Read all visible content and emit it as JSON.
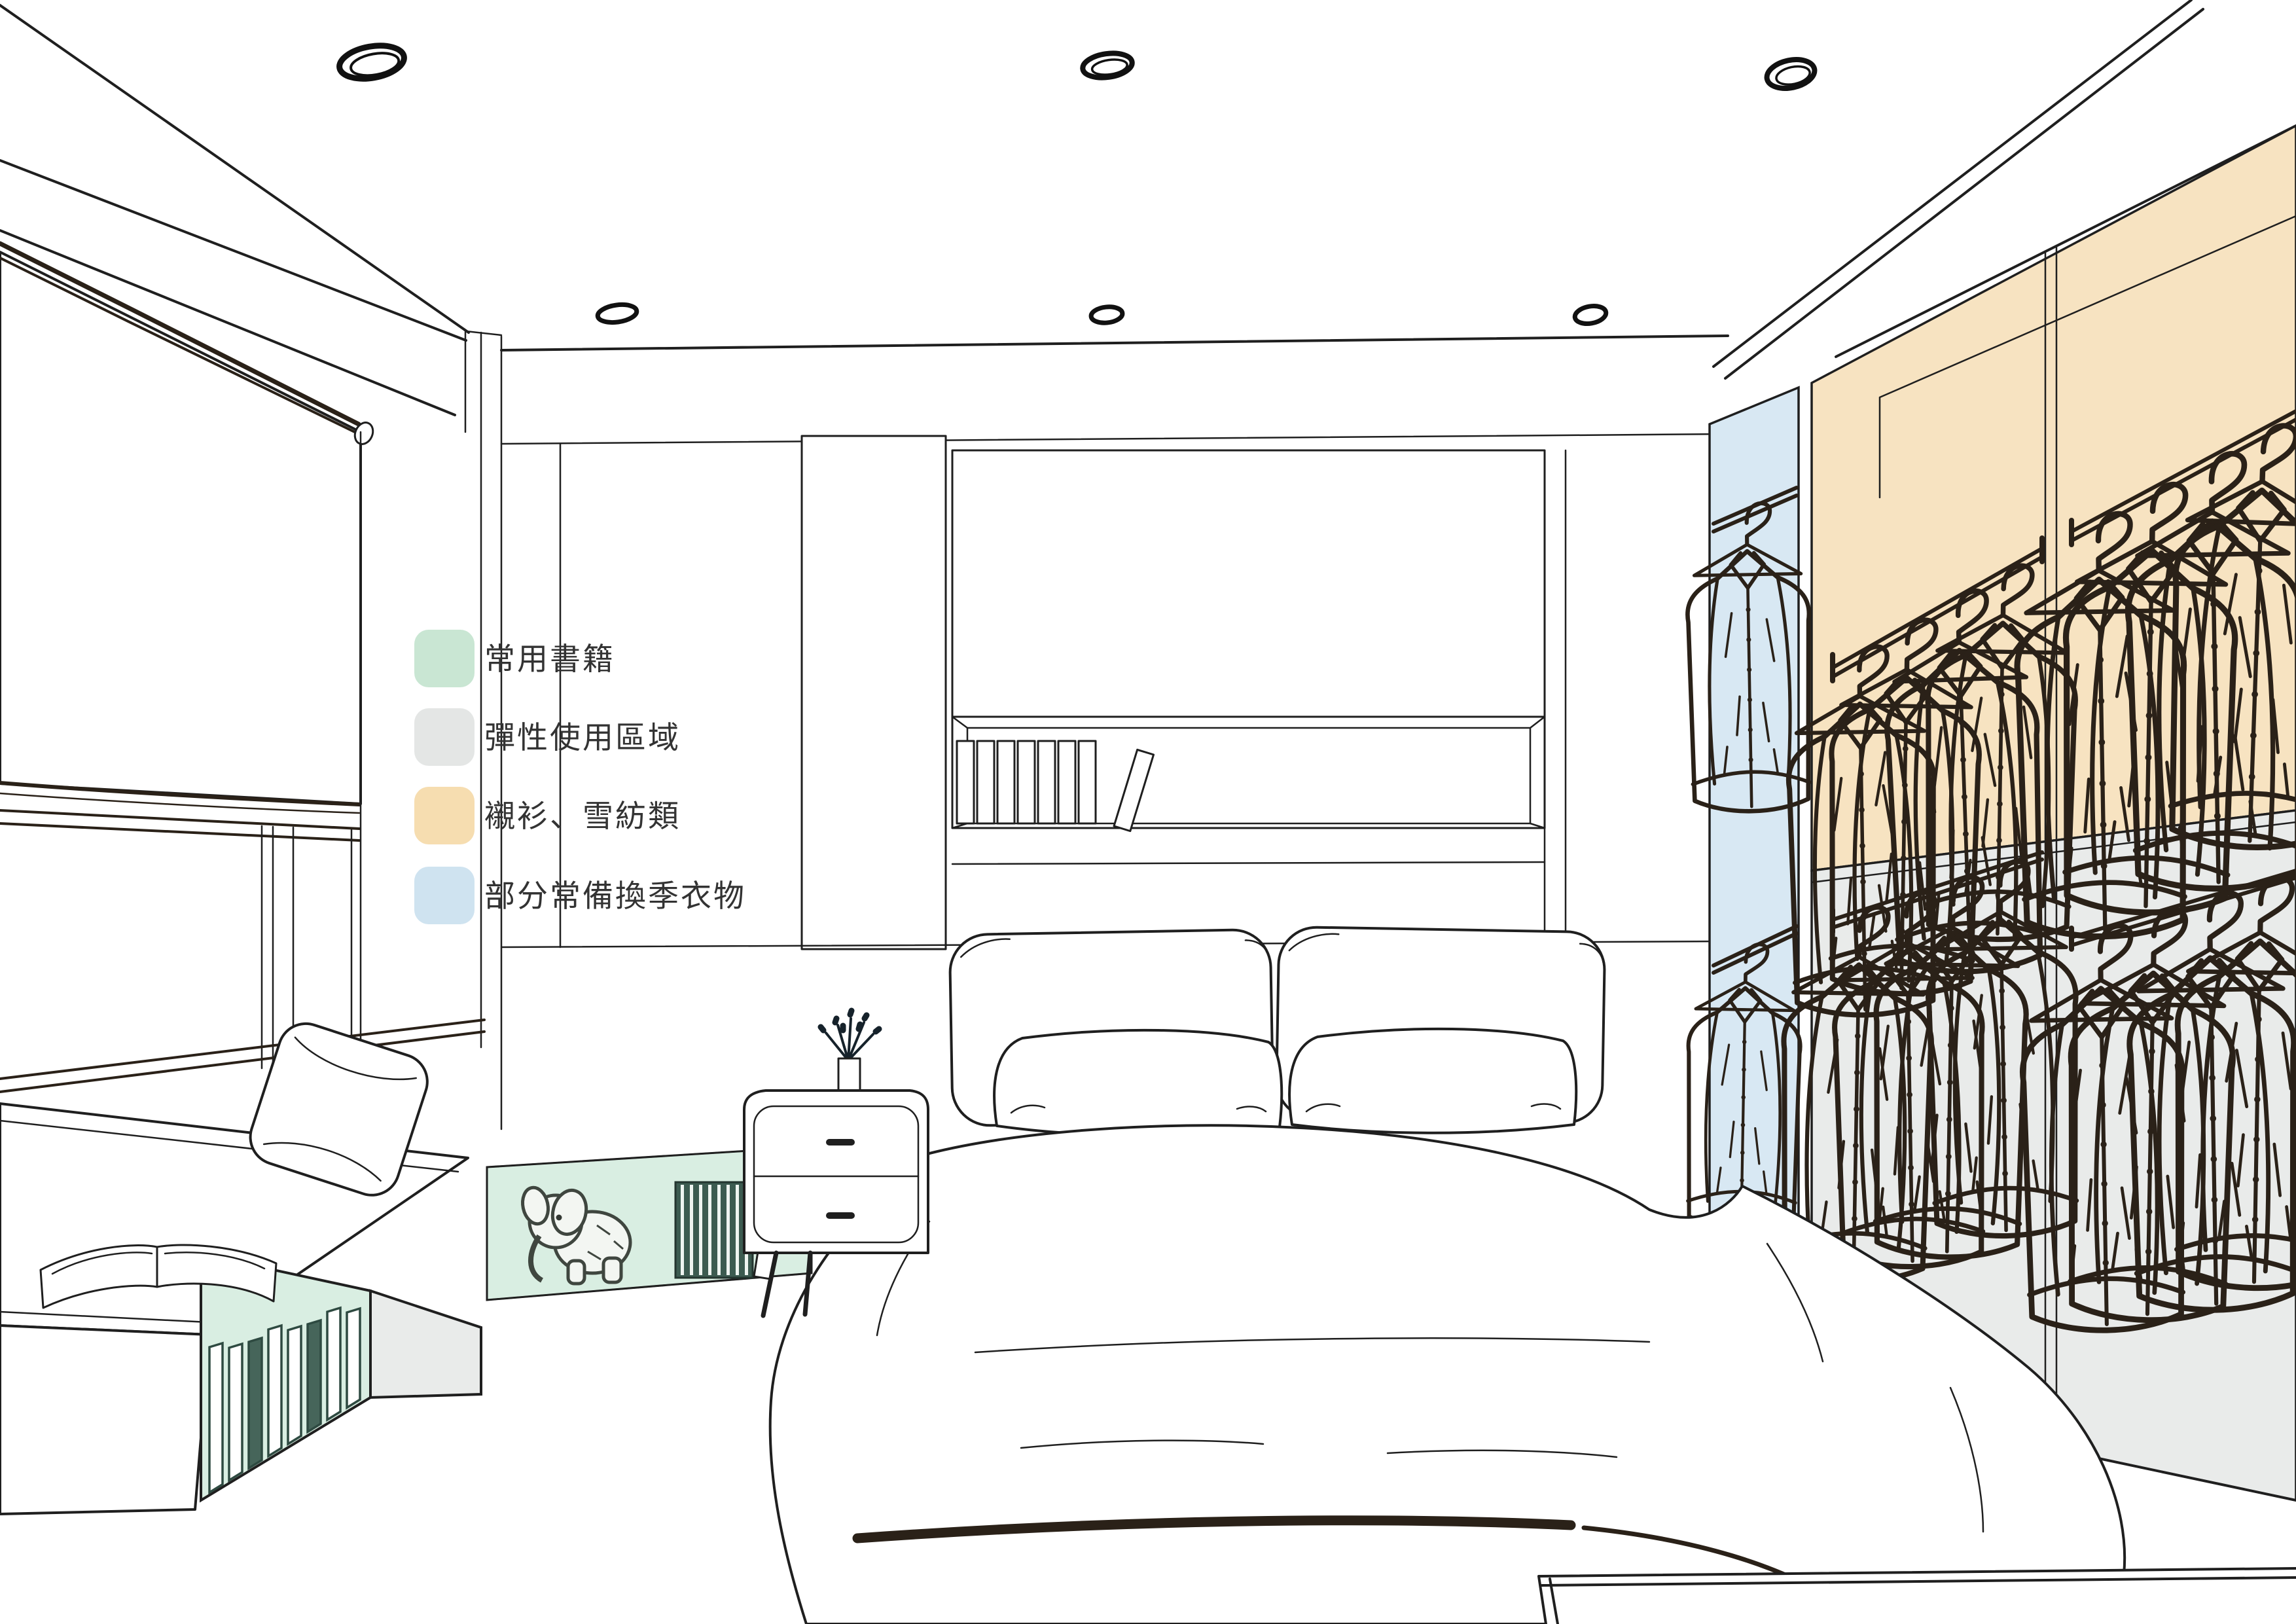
{
  "legend": {
    "items": [
      {
        "id": "books",
        "label": "常用書籍",
        "color": "#c9e6d3"
      },
      {
        "id": "flex",
        "label": "彈性使用區域",
        "color": "#e4e6e5"
      },
      {
        "id": "shirts",
        "label": "襯衫、雪紡類",
        "color": "#f6ddb0"
      },
      {
        "id": "seasonal",
        "label": "部分常備換季衣物",
        "color": "#cfe3f0"
      }
    ]
  },
  "scene": {
    "colors": {
      "line": "#1f1f1f",
      "sketch": "#2a2118",
      "green_area": "#d9eee2",
      "gray_area": "#e9ebea",
      "orange_area": "#f7e3c1",
      "blue_area": "#d8e8f3"
    },
    "regions": [
      {
        "name": "bench-bookshelf",
        "legend_label": "常用書籍"
      },
      {
        "name": "under-window-shelf",
        "legend_label": "常用書籍"
      },
      {
        "name": "bench-open-compartment",
        "legend_label": "彈性使用區域"
      },
      {
        "name": "wardrobe-lower-bays",
        "legend_label": "彈性使用區域"
      },
      {
        "name": "wardrobe-upper-bays",
        "legend_label": "襯衫、雪紡類"
      },
      {
        "name": "wardrobe-side-column",
        "legend_label": "部分常備換季衣物"
      }
    ]
  }
}
